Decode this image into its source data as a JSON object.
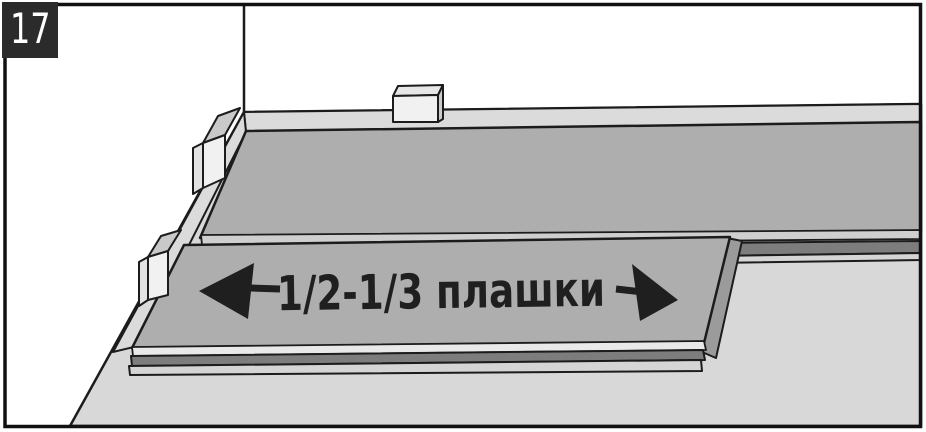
{
  "step_badge": {
    "number": "17"
  },
  "annotation": {
    "text": "1/2-1/3 плашки",
    "arrows": {
      "left": "solid-left-arrow",
      "right": "solid-right-arrow"
    }
  },
  "colors": {
    "wall": "#ffffff",
    "floor_underlay": "#d8d8d8",
    "baseboard": "#dbdbdb",
    "plank_top": "#aeaeae",
    "plank_bevel": "#cfcfcf",
    "plank_bevel_light": "#e9e9e9",
    "plank_edge_dark": "#7d7d7d",
    "plank_edge_light": "#d5d5d5",
    "plank_end_face": "#9b9b9b",
    "spacer_front": "#f1f1f1",
    "spacer_top": "#e7e7e7",
    "spacer_top_side": "#c9c9c9",
    "spacer_edge": "#e3e3e3",
    "spacer_side": "#cbcbcb",
    "outline": "#1c1c1c",
    "ink": "#1f1f1f",
    "badge_background": "#2b2b2b",
    "badge_text": "#ffffff",
    "frame_border": "#111111"
  }
}
